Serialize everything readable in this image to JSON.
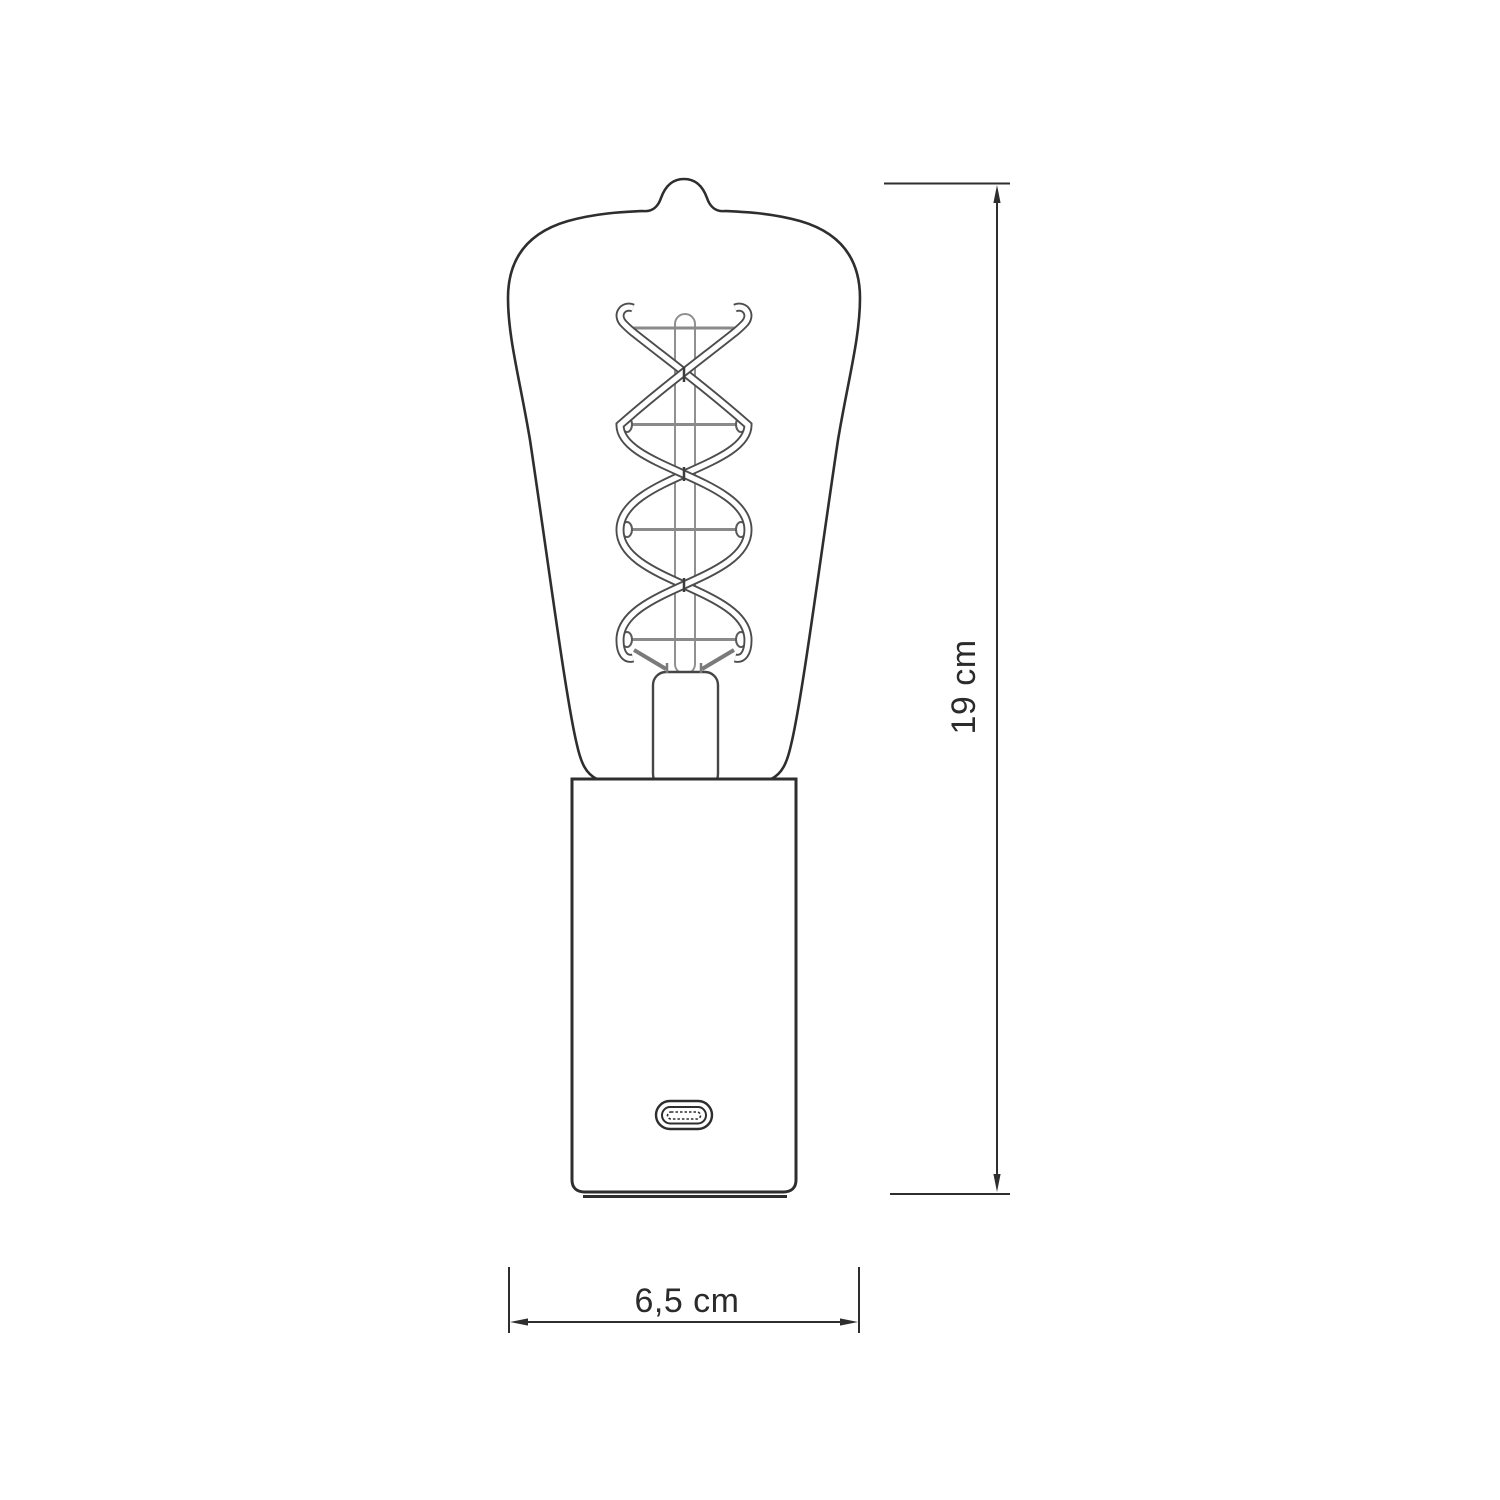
{
  "page": {
    "background_color": "#ffffff"
  },
  "drawing": {
    "kind": "technical-line-drawing",
    "subject": "Table lamp with ST64 Edison bulb, double-spiral filament, cylindrical base and USB-C port",
    "outline_color": "#2e2e2e",
    "filament_wire_color": "#8a8a8a",
    "filament_ribbon_color": "#4d4d4d",
    "label_color": "#2b2b2b"
  },
  "icons": {
    "usb_c_port": "usb-c-port"
  },
  "dimensions": {
    "height": {
      "label": "19 cm",
      "value": 19,
      "unit": "cm"
    },
    "width": {
      "label": "6,5 cm",
      "value": 6.5,
      "unit": "cm"
    }
  }
}
